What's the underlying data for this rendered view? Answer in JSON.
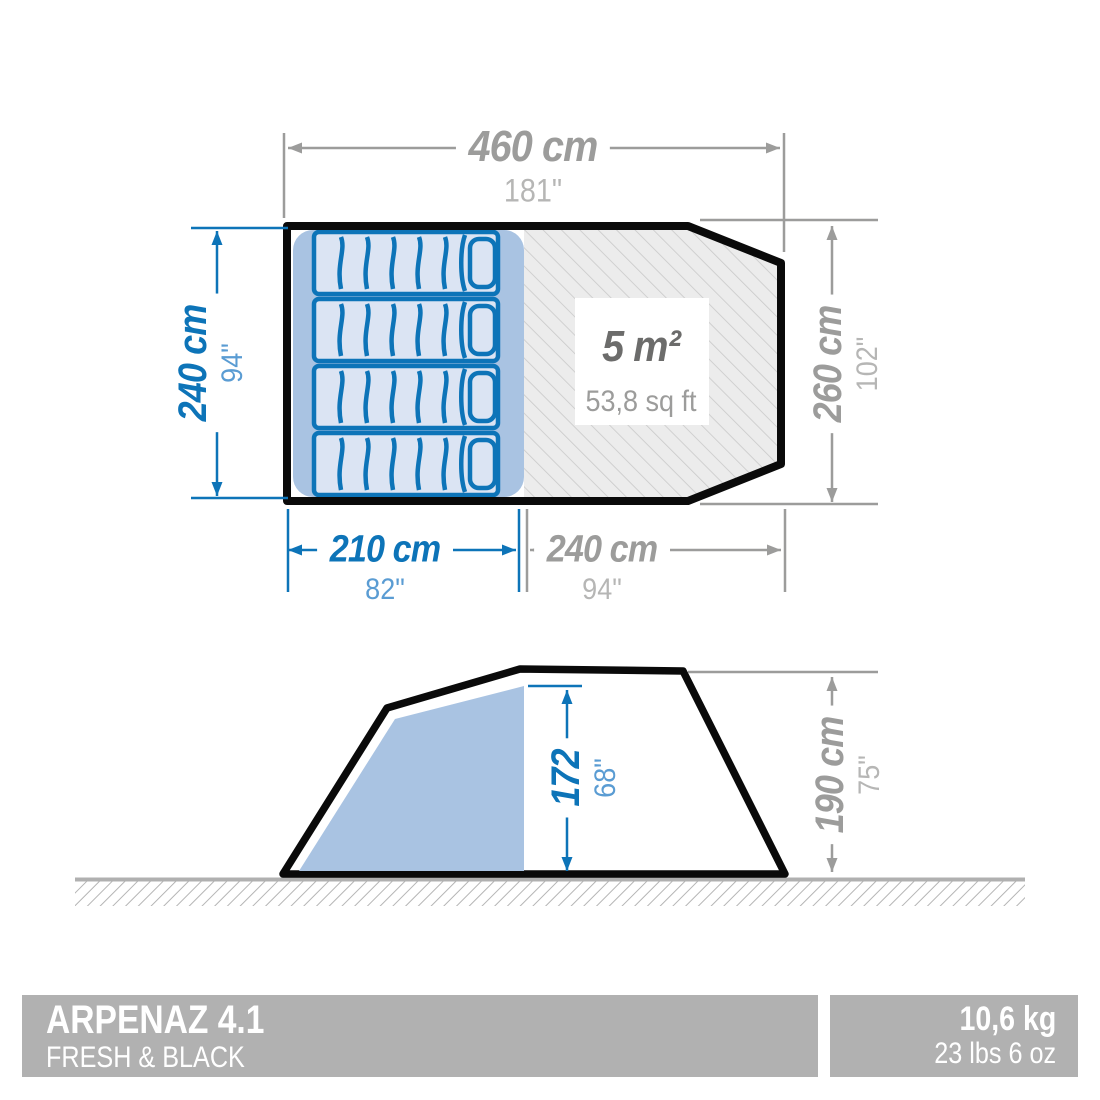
{
  "product": {
    "name": "ARPENAZ 4.1",
    "line": "FRESH & BLACK",
    "weight_kg": "10,6 kg",
    "weight_lbs": "23 lbs 6 oz"
  },
  "plan": {
    "total_width": {
      "value": "460 cm",
      "inches": "181\""
    },
    "bedroom_depth": {
      "value": "240 cm",
      "inches": "94\""
    },
    "total_depth": {
      "value": "260 cm",
      "inches": "102\""
    },
    "bedroom_width": {
      "value": "210 cm",
      "inches": "82\""
    },
    "living_width": {
      "value": "240 cm",
      "inches": "94\""
    },
    "living_area": {
      "value": "5 m²",
      "imperial": "53,8 sq ft"
    }
  },
  "side": {
    "inner_height": {
      "value": "172",
      "inches": "68\""
    },
    "outer_height": {
      "value": "190 cm",
      "inches": "75\""
    }
  },
  "colors": {
    "accent_blue": "#0d74b8",
    "light_blue": "#a9c3e2",
    "bed_fill": "#dbe4f3",
    "dim_gray": "#9c9c9b",
    "banner_gray": "#b1b1b1",
    "outline_black": "#0a0a0a"
  }
}
